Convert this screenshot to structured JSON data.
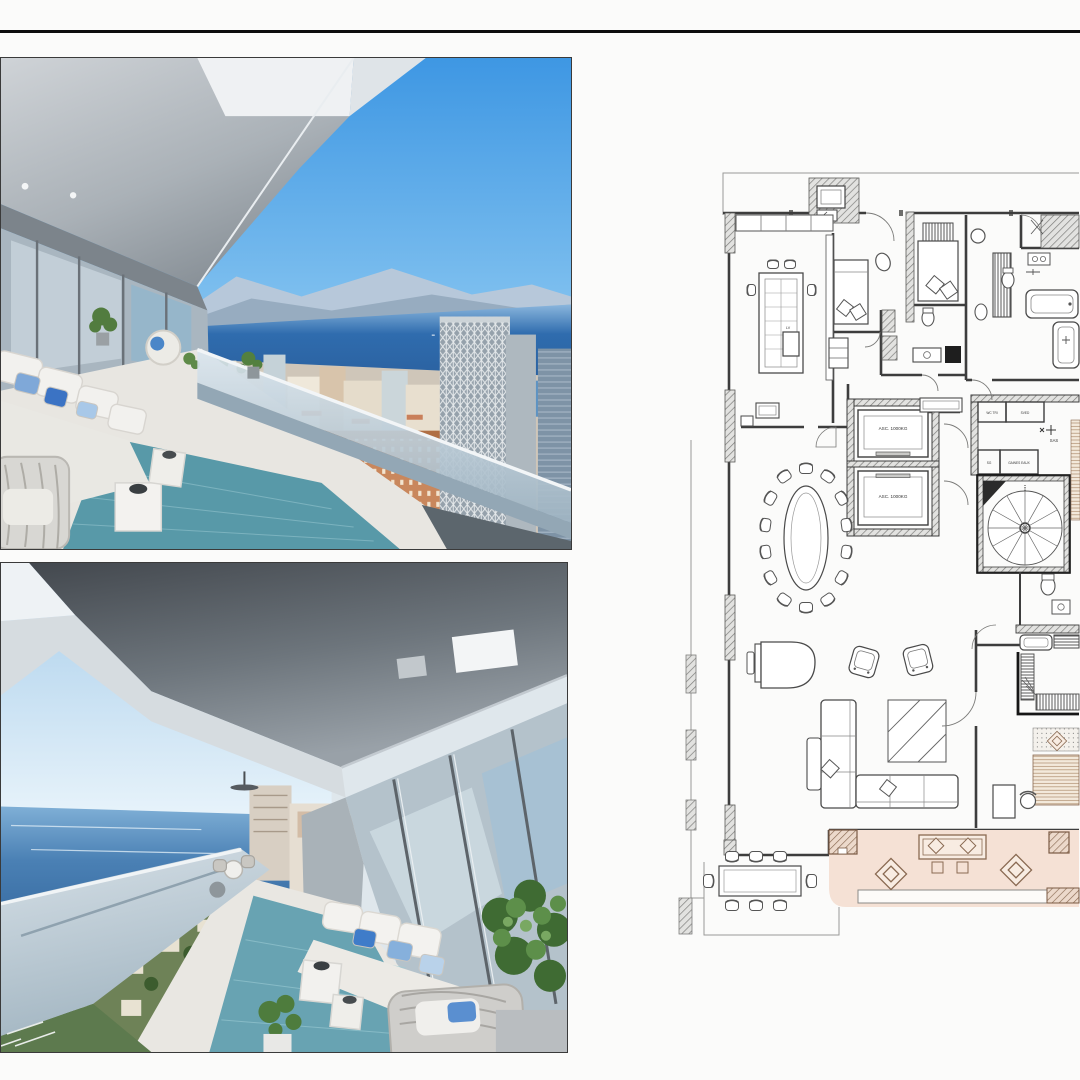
{
  "page": {
    "background": "#fbfbfa",
    "divider_color": "#0d0d0d"
  },
  "photos": {
    "top": {
      "description": "Covered terrace with white sofa and blue cushions overlooking Monte Carlo, the harbour and the bay"
    },
    "bottom": {
      "description": "Covered terrace with lounge seating, plants and teal rug overlooking the sea and hillside town"
    }
  },
  "floorplan": {
    "labels": {
      "elevator_1": "ASC. 1000KG",
      "elevator_2": "ASC. 1000KG",
      "sas": "SAS",
      "wc_tri": "WC TRI",
      "duct_top": "SVED",
      "sg": "SG",
      "duct_left": "GAINES EAUX",
      "dishwasher": "LV"
    },
    "colors": {
      "terrace_fill": "#f5e1d5",
      "terrace_wood": "#8a6a52",
      "wall": "#3d3d3d"
    }
  }
}
